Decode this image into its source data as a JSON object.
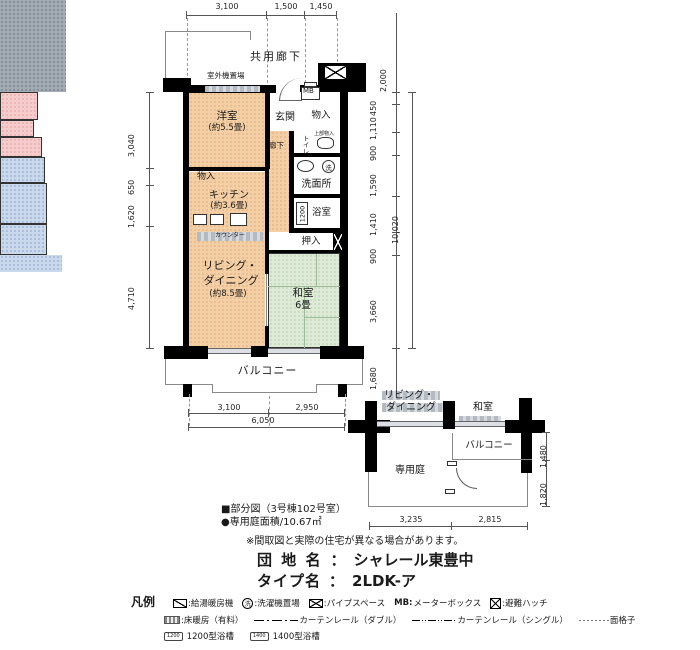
{
  "plan": {
    "corridor": "共用廊下",
    "outdoor_unit": "室外機置場",
    "rooms": {
      "yoshitsu": "洋室",
      "yoshitsu_size": "(約5.5畳)",
      "genkan": "玄関",
      "mb": "MB",
      "monoire_top": "物入",
      "rouka": "廊下",
      "toilet": "トイレ",
      "toilet_upper": "上部物入",
      "senmenjo": "洗面所",
      "washer": "洗",
      "yokushitsu": "浴室",
      "bath_size": "1200",
      "monoire_kitchen": "物入",
      "kitchen": "キッチン",
      "kitchen_size": "(約3.6畳)",
      "counter": "カウンター",
      "oshiire": "押入",
      "living_1": "リビング・",
      "living_2": "ダイニング",
      "living_size": "(約8.5畳)",
      "washitsu": "和室",
      "washitsu_size": "6畳",
      "balcony": "バルコニー"
    },
    "dims": {
      "top": [
        "3,100",
        "1,500",
        "1,450"
      ],
      "left": [
        "3,040",
        "650",
        "1,620",
        "4,710"
      ],
      "right": [
        "450",
        "1,110",
        "900",
        "1,590",
        "1,410",
        "900",
        "3,660"
      ],
      "right_total": "10,020",
      "right_top": "2,000",
      "right_bottom": "1,680",
      "bottom": [
        "3,100",
        "2,950"
      ],
      "bottom_total": "6,050"
    }
  },
  "subplan": {
    "living_1": "リビング・",
    "living_2": "ダイニング",
    "washitsu": "和室",
    "balcony": "バルコニー",
    "garden": "専用庭",
    "dims": {
      "right": [
        "1,480",
        "1,820"
      ],
      "bottom": [
        "3,235",
        "2,815"
      ]
    }
  },
  "notes": {
    "partial": "■部分図（3号棟102号室）",
    "garden_area": "●専用庭面積/10.67㎡",
    "disclaimer": "※間取図と実際の住宅が異なる場合があります。"
  },
  "titles": {
    "danchi_label": "団 地 名",
    "danchi_colon": "：",
    "danchi_value": "シャレール東豊中",
    "type_label": "タイプ名",
    "type_colon": "：",
    "type_value": "2LDK-ア"
  },
  "legend": {
    "title": "凡例",
    "heater": ":給湯暖房機",
    "washer_icon": "洗",
    "washer": ":洗濯機置場",
    "pipe_space": ":パイプスペース",
    "mb_icon": "MB:",
    "mb": "メーターボックス",
    "hatch": ":避難ハッチ",
    "floor_heating": ":床暖房（有料）",
    "rail_double": "カーテンレール（ダブル）",
    "rail_single": "カーテンレール（シングル）",
    "lattice": "面格子",
    "bath1200_icon": "1200",
    "bath1200": "1200型浴槽",
    "bath1400_icon": "1400",
    "bath1400": "1400型浴槽"
  },
  "colors": {
    "wall": "#000000",
    "western_room": "#f4cfa6",
    "wet_area": "#c9d8ea",
    "closet": "#f6cbcb",
    "tatami": "#dcead6",
    "rug": "#a2abb4"
  }
}
